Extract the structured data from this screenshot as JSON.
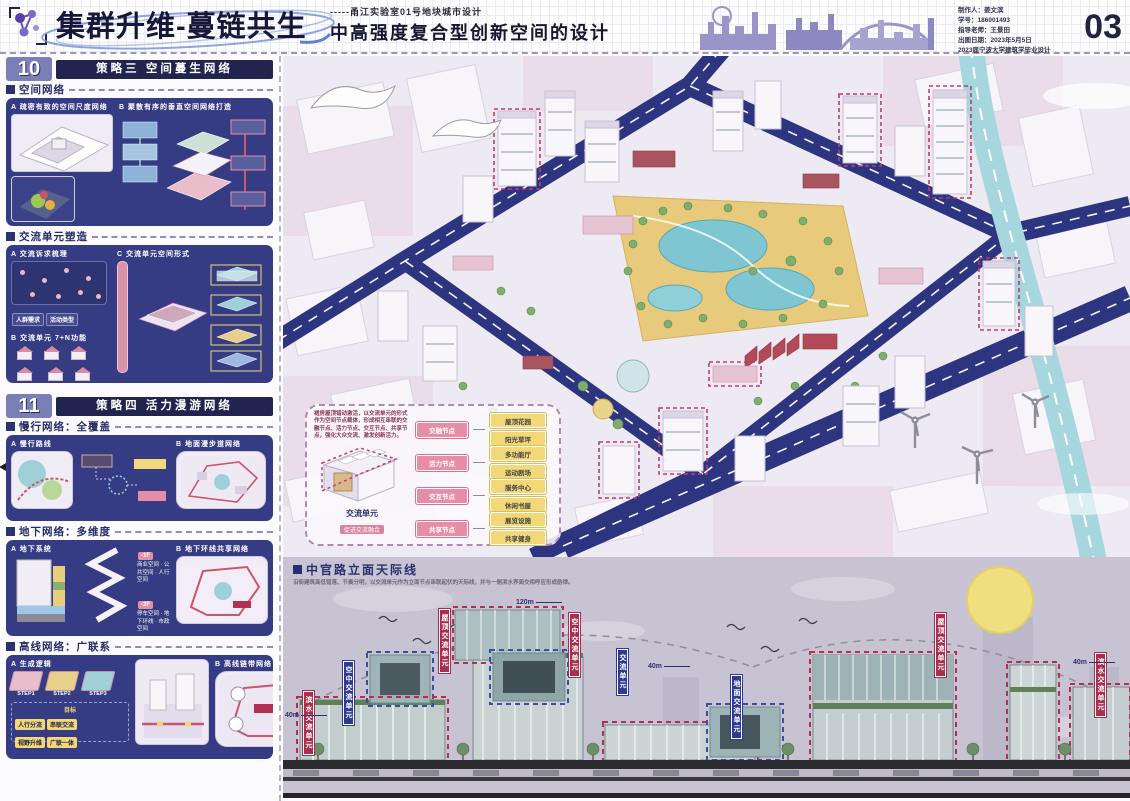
{
  "header": {
    "brand_title": "集群升维-蔓链共生",
    "subtitle_small": "-----甬江实验室01号地块城市设计",
    "subtitle_big": "中高强度复合型创新空间的设计",
    "credits": {
      "line1": "制作人：姜文滨",
      "line2": "学号：186001493",
      "line3": "指导老师：王景田",
      "line4": "出图日期：2023年5月5日",
      "line5": "2023届宁波大学建筑学毕业设计"
    },
    "page_number": "03"
  },
  "sidebar": {
    "s10": {
      "num": "10",
      "title": "策略三 空间蔓生网络",
      "space_label": "空间网络",
      "space_a": "A 疏密有致的空间尺度网络",
      "space_b": "B 聚散有序的垂直空间网络打造",
      "unit_label": "交流单元塑造",
      "unit_a": "A 交流诉求梳理",
      "unit_c": "C 交流单元空间形式",
      "unit_b": "B 交流单元 7+N功能"
    },
    "s11": {
      "num": "11",
      "title": "策略四 活力漫游网络",
      "walk_label": "慢行网络：全覆盖",
      "walk_a": "A 慢行路线",
      "walk_b": "B 地面漫步道网络",
      "under_label": "地下网络：多维度",
      "under_a": "A 地下系统",
      "under_b": "B 地下环线共享网络",
      "f1": "-1F",
      "f1_items": "商业空间 · 公共空间 · 人行空间",
      "f2": "-2F",
      "f2_items": "停车空间 · 地下环线 · 市政空间",
      "high_label": "高线网络：广联系",
      "high_a": "A 生成逻辑",
      "high_b": "B 高线链带网络",
      "steps": [
        "STEP1",
        "STEP2",
        "STEP3"
      ],
      "goal": "目标"
    }
  },
  "callout": {
    "note": "裙房屋顶错动激活，以交流单元的形式作为空间节点载体，形成相互串联的交融节点、活力节点、交互节点、共享节点，强化大众交流、激发创新活力。",
    "unit": "交流单元",
    "unit_sub": "促进交流融合",
    "pink": [
      "交融节点",
      "活力节点",
      "交互节点",
      "共享节点"
    ],
    "yellow": [
      "屋顶花园",
      "阳光草坪",
      "多功能厅",
      "运动剧场",
      "服务中心",
      "休闲书屋",
      "展览设施",
      "共享健身"
    ]
  },
  "elevation": {
    "title": "中官路立面天际线",
    "desc": "沿街建筑高低错落、节奏分明，以交流单元作为立面节点串联起伏的天际线，并与一侧滨水界面交相呼应形成韵律。",
    "banners": [
      "滨水交流单元",
      "空中交流单元",
      "屋顶交流单元",
      "空中交流单元",
      "交流单元",
      "屋顶交流单元",
      "地面交流单元",
      "滨水交流单元"
    ],
    "h120": "120m",
    "h40": "40m"
  },
  "colors": {
    "panel_navy": "#363c83",
    "bar_navy": "#20244f",
    "road_navy": "#2d3480",
    "accent_pink": "#e78da6",
    "accent_yellow": "#f2d878",
    "magenta_dash": "#c13b6e",
    "banner_red": "#a82e4e",
    "water_teal": "#a6d7de",
    "sun_yellow": "#efdf7f"
  }
}
